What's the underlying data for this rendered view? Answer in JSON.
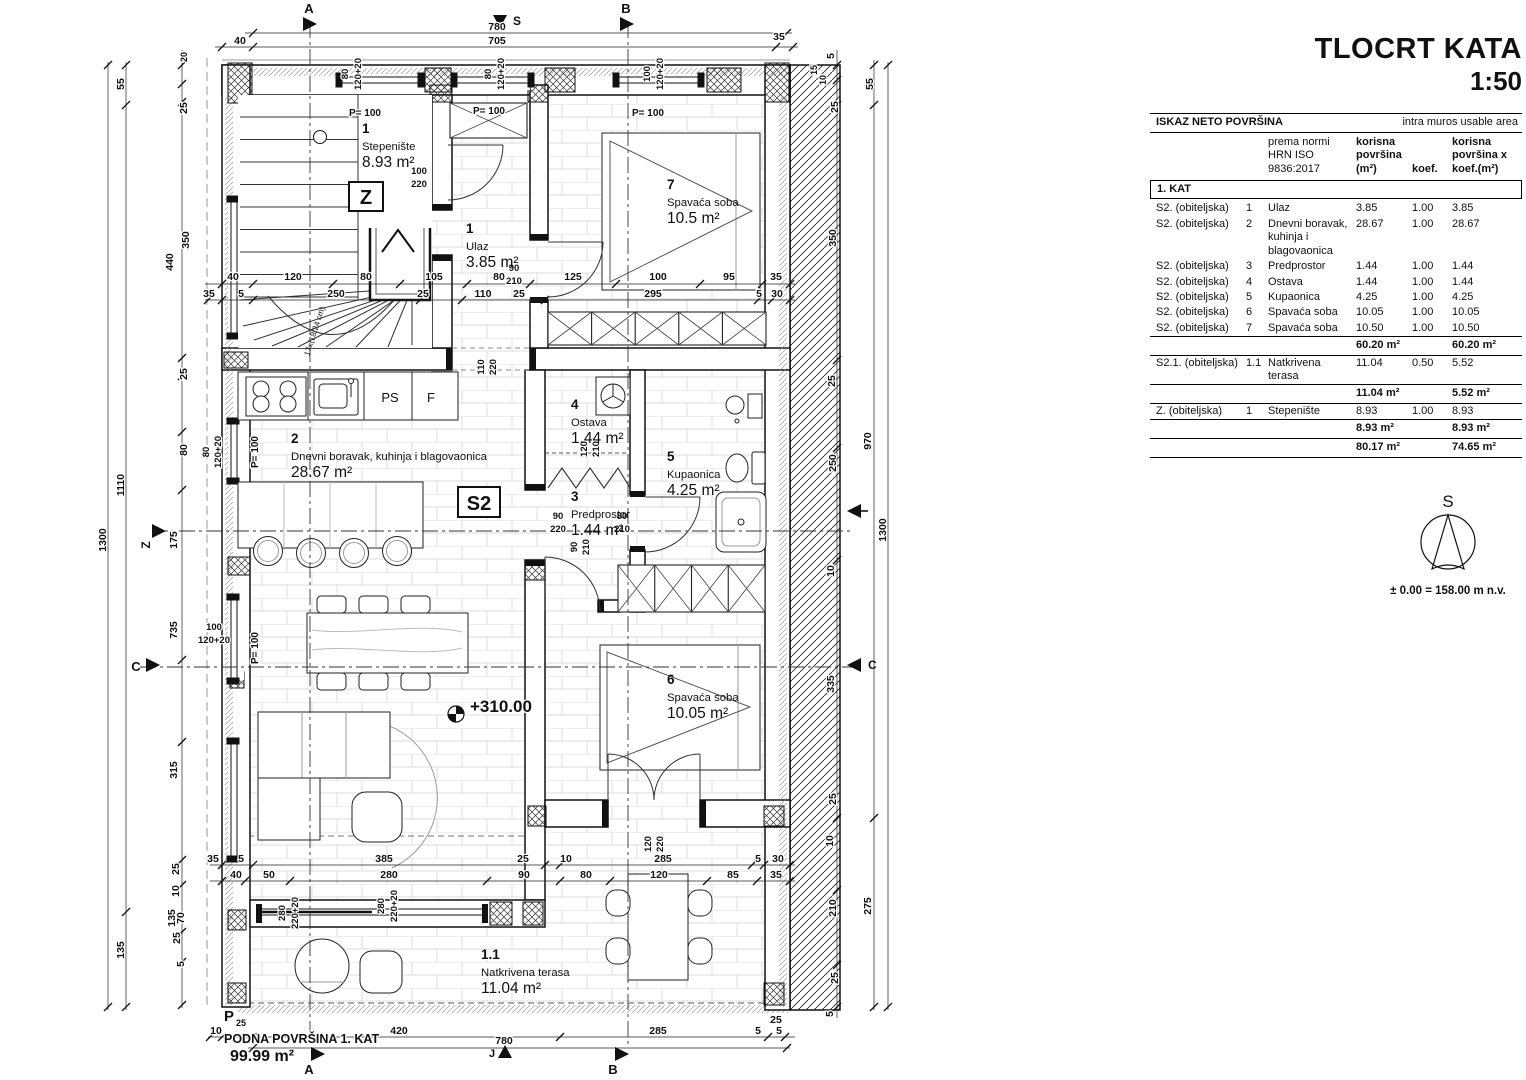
{
  "title": {
    "line1": "TLOCRT KATA",
    "line2": "1:50"
  },
  "table": {
    "header_left": "ISKAZ NETO POVRŠINA",
    "header_right": "intra muros usable area",
    "col_norm": "prema normi\nHRN ISO\n9836:2017",
    "col_area": "korisna\npovršina\n(m²)",
    "col_koef": "koef.",
    "col_areax": "korisna\npovršina x\nkoef.(m²)",
    "section": "1. KAT",
    "rows": [
      {
        "unit": "S2. (obiteljska)",
        "num": "1",
        "name": "Ulaz",
        "area": "3.85",
        "koef": "1.00",
        "areax": "3.85"
      },
      {
        "unit": "S2. (obiteljska)",
        "num": "2",
        "name": "Dnevni boravak, kuhinja i blagovaonica",
        "area": "28.67",
        "koef": "1.00",
        "areax": "28.67"
      },
      {
        "unit": "S2. (obiteljska)",
        "num": "3",
        "name": "Predprostor",
        "area": "1.44",
        "koef": "1.00",
        "areax": "1.44"
      },
      {
        "unit": "S2. (obiteljska)",
        "num": "4",
        "name": "Ostava",
        "area": "1.44",
        "koef": "1.00",
        "areax": "1.44"
      },
      {
        "unit": "S2. (obiteljska)",
        "num": "5",
        "name": "Kupaonica",
        "area": "4.25",
        "koef": "1.00",
        "areax": "4.25"
      },
      {
        "unit": "S2. (obiteljska)",
        "num": "6",
        "name": "Spavaća soba",
        "area": "10.05",
        "koef": "1.00",
        "areax": "10.05"
      },
      {
        "unit": "S2. (obiteljska)",
        "num": "7",
        "name": "Spavaća soba",
        "area": "10.50",
        "koef": "1.00",
        "areax": "10.50"
      }
    ],
    "subtotal1": {
      "area": "60.20 m²",
      "areax": "60.20 m²"
    },
    "row_terrace": {
      "unit": "S2.1. (obiteljska)",
      "num": "1.1",
      "name": "Natkrivena terasa",
      "area": "11.04",
      "koef": "0.50",
      "areax": "5.52"
    },
    "subtotal2": {
      "area": "11.04 m²",
      "areax": "5.52 m²"
    },
    "row_stairs": {
      "unit": "Z. (obiteljska)",
      "num": "1",
      "name": "Stepenište",
      "area": "8.93",
      "koef": "1.00",
      "areax": "8.93"
    },
    "subtotal3": {
      "area": "8.93 m²",
      "areax": "8.93 m²"
    },
    "total": {
      "area": "80.17 m²",
      "areax": "74.65 m²"
    }
  },
  "compass": {
    "north": "S",
    "level": "± 0.00 = 158.00 m n.v."
  },
  "plan": {
    "rooms": [
      {
        "num": "1",
        "name": "Stepenište",
        "area": "8.93 m²"
      },
      {
        "num": "1",
        "name": "Ulaz",
        "area": "3.85 m²"
      },
      {
        "num": "7",
        "name": "Spavaća soba",
        "area": "10.5 m²"
      },
      {
        "num": "2",
        "name": "Dnevni boravak, kuhinja i blagovaonica",
        "area": "28.67 m²"
      },
      {
        "num": "4",
        "name": "Ostava",
        "area": "1.44 m²"
      },
      {
        "num": "5",
        "name": "Kupaonica",
        "area": "4.25 m²"
      },
      {
        "num": "3",
        "name": "Predprostor",
        "area": "1.44 m²"
      },
      {
        "num": "6",
        "name": "Spavaća soba",
        "area": "10.05 m²"
      },
      {
        "num": "1.1",
        "name": "Natkrivena terasa",
        "area": "11.04 m²"
      }
    ],
    "unit_label": "S2",
    "stair_label": "Z",
    "ps_label": "PS",
    "f_label": "F",
    "level_mark": "+310.00",
    "stair_note": "17x(18/24 cm)",
    "floor_area_label": "PODNA POVRŠINA 1. KAT",
    "floor_area_value": "99.99 m²",
    "p_mark": "P",
    "p_sub": "25",
    "markers": {
      "a": "A",
      "b": "B",
      "c": "C",
      "z": "Z",
      "i": "I",
      "s": "S",
      "j": "J"
    },
    "dims": {
      "top": [
        "780",
        "40",
        "705",
        "35"
      ],
      "win_top": [
        "80",
        "120+20",
        "80",
        "120+20",
        "100",
        "120+20"
      ],
      "p100": [
        "P= 100",
        "P= 100",
        "P= 100",
        "P= 100",
        "P= 100"
      ],
      "mid_a": [
        "40",
        "120",
        "80",
        "105",
        "80",
        "125",
        "100",
        "95",
        "35"
      ],
      "mid_b": [
        "35",
        "5",
        "250",
        "25",
        "110",
        "25",
        "295",
        "5",
        "30"
      ],
      "door_pairs": [
        "90",
        "210",
        "100",
        "220",
        "90",
        "220",
        "80",
        "210",
        "100",
        "120+20"
      ],
      "vert_pairs": [
        "280",
        "220+20",
        "280",
        "220+20",
        "120",
        "220",
        "120",
        "210",
        "90",
        "210",
        "110",
        "220",
        "80",
        "120+20"
      ],
      "left": [
        "1300",
        "55",
        "1110",
        "135",
        "20",
        "25",
        "350",
        "440",
        "25",
        "80",
        "175",
        "735",
        "315",
        "25",
        "10",
        "70",
        "135",
        "25",
        "5"
      ],
      "right": [
        "5",
        "15",
        "10",
        "25",
        "350",
        "25",
        "250",
        "10",
        "335",
        "25",
        "10",
        "210",
        "25",
        "5",
        "55",
        "970",
        "1300",
        "275"
      ],
      "bot_a": [
        "35",
        "5",
        "385",
        "25",
        "10",
        "285",
        "5",
        "30"
      ],
      "bot_b": [
        "40",
        "50",
        "280",
        "90",
        "80",
        "120",
        "85",
        "35"
      ],
      "bot_out": [
        "10",
        "420",
        "285",
        "25",
        "5",
        "5",
        "780"
      ]
    }
  }
}
